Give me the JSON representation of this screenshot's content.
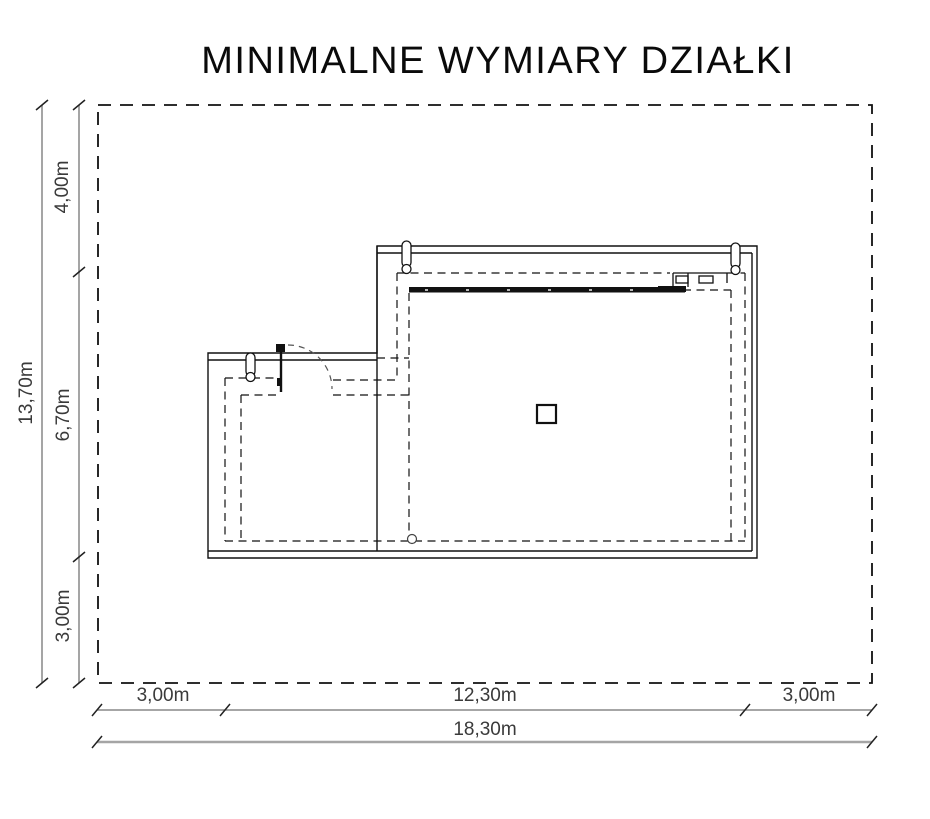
{
  "title": "MINIMALNE WYMIARY DZIAŁKI",
  "dimensions": {
    "left": {
      "total": "13,70m",
      "segments": [
        "4,00m",
        "6,70m",
        "3,00m"
      ]
    },
    "bottom": {
      "segments": [
        "3,00m",
        "12,30m",
        "3,00m"
      ],
      "total": "18,30m"
    }
  },
  "colors": {
    "drawing_line": "#111111",
    "plot_boundary": "#111111",
    "dimension_line": "#a5a5a5",
    "tick": "#222222",
    "label_text": "#3a3a3a"
  }
}
